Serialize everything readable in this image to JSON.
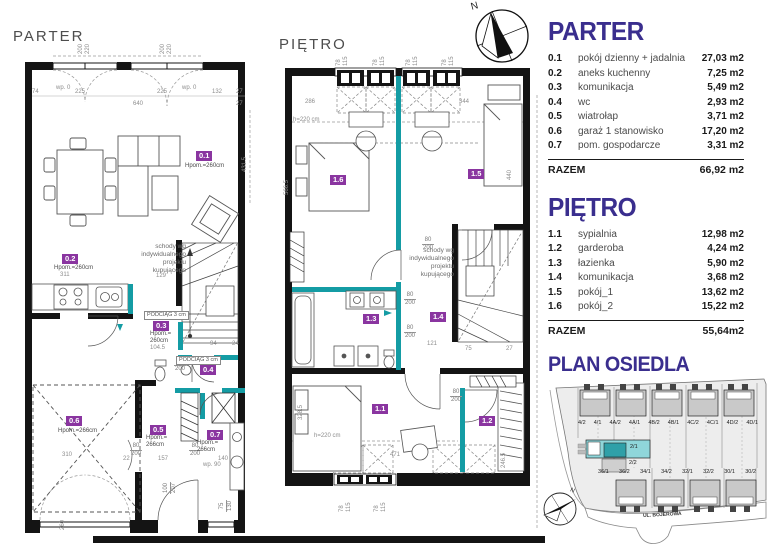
{
  "colors": {
    "accent_teal": "#149CA4",
    "heading_purple": "#3A2E8E",
    "badge_purple": "#8A35A0",
    "site_highlight": "#8FD6DA",
    "site_highlight_dark": "#2FA0A8",
    "wall_black": "#141414"
  },
  "compass_top": {
    "north": "N"
  },
  "compass_site": {
    "north": "N"
  },
  "parter_plan": {
    "title": "PARTER",
    "badges": {
      "b01": {
        "id": "0.1",
        "height": "Hpom.=260cm"
      },
      "b02": {
        "id": "0.2",
        "height": "Hpom.=260cm"
      },
      "b03": {
        "id": "0.3",
        "height": "Hpom.= 260cm"
      },
      "b04": {
        "id": "0.4"
      },
      "b05": {
        "id": "0.5",
        "height": "Hpom.= 266cm"
      },
      "b06": {
        "id": "0.6",
        "height": "Hpom.=266cm"
      },
      "b07": {
        "id": "0.7",
        "height": "Hpom.= 266cm"
      }
    },
    "stair_note": "schody wg indywidualnego projektu kupującego",
    "beam_note_a": "PODCIĄG 3 cm",
    "beam_note_b": "PODCIĄG 3 cm",
    "wp0": "wp. 0",
    "wp90": "wp. 90",
    "dims": {
      "d74": "74",
      "d225": "225",
      "d640": "640",
      "d132": "132",
      "d27": "27",
      "d200": "200",
      "d220": "220",
      "d311": "311",
      "d129": "129",
      "d104": "104.5",
      "d310": "310",
      "d22": "22",
      "d157": "157",
      "d140": "140",
      "d80": "80",
      "d100": "100",
      "d207": "207",
      "d75": "75",
      "d130": "130",
      "d94": "94",
      "d24": "24",
      "d431": "431.5",
      "d260": "260"
    }
  },
  "pietro_plan": {
    "title": "PIĘTRO",
    "badges": {
      "b11": {
        "id": "1.1"
      },
      "b12": {
        "id": "1.2"
      },
      "b13": {
        "id": "1.3"
      },
      "b14": {
        "id": "1.4"
      },
      "b15": {
        "id": "1.5"
      },
      "b16": {
        "id": "1.6"
      }
    },
    "stair_note": "schody wg indywidualnego projektu kupującego",
    "h220": "h=220 cm",
    "dims": {
      "d286": "286",
      "d344": "344",
      "d78": "78",
      "d115": "115",
      "d471": "471",
      "d121": "121",
      "d80": "80",
      "d200": "200",
      "d75": "75",
      "d27": "27",
      "d566": "566.5",
      "d328": "328.5",
      "d246": "246.5",
      "d440": "440"
    }
  },
  "legend": {
    "parter": {
      "title": "PARTER",
      "rows": [
        {
          "no": "0.1",
          "name": "pokój dzienny + jadalnia",
          "area": "27,03 m2"
        },
        {
          "no": "0.2",
          "name": "aneks kuchenny",
          "area": "7,25 m2"
        },
        {
          "no": "0.3",
          "name": "komunikacja",
          "area": "5,49 m2"
        },
        {
          "no": "0.4",
          "name": "wc",
          "area": "2,93 m2"
        },
        {
          "no": "0.5",
          "name": "wiatrołap",
          "area": "3,71 m2"
        },
        {
          "no": "0.6",
          "name": "garaż 1 stanowisko",
          "area": "17,20 m2"
        },
        {
          "no": "0.7",
          "name": "pom. gospodarcze",
          "area": "3,31 m2"
        }
      ],
      "total_label": "RAZEM",
      "total": "66,92 m2"
    },
    "pietro": {
      "title": "PIĘTRO",
      "rows": [
        {
          "no": "1.1",
          "name": "sypialnia",
          "area": "12,98 m2"
        },
        {
          "no": "1.2",
          "name": "garderoba",
          "area": "4,24 m2"
        },
        {
          "no": "1.3",
          "name": "łazienka",
          "area": "5,90 m2"
        },
        {
          "no": "1.4",
          "name": "komunikacja",
          "area": "3,68 m2"
        },
        {
          "no": "1.5",
          "name": "pokój_1",
          "area": "13,62 m2"
        },
        {
          "no": "1.6",
          "name": "pokój_2",
          "area": "15,22 m2"
        }
      ],
      "total_label": "RAZEM",
      "total": "55,64m2"
    }
  },
  "site_plan": {
    "title": "PLAN OSIEDLA",
    "street": "UL. BOJEROWA",
    "top_lots": [
      "4/2",
      "4/1",
      "4A/2",
      "4A/1",
      "4B/2",
      "4B/1",
      "4C/2",
      "4C/1",
      "4D/2",
      "4D/1"
    ],
    "mid_lot_highlight": "2/1",
    "mid_lot_below": "2/2",
    "bottom_lots": [
      "36/1",
      "36/2",
      "34/1",
      "34/2",
      "32/1",
      "32/2",
      "30/1",
      "30/2"
    ]
  }
}
